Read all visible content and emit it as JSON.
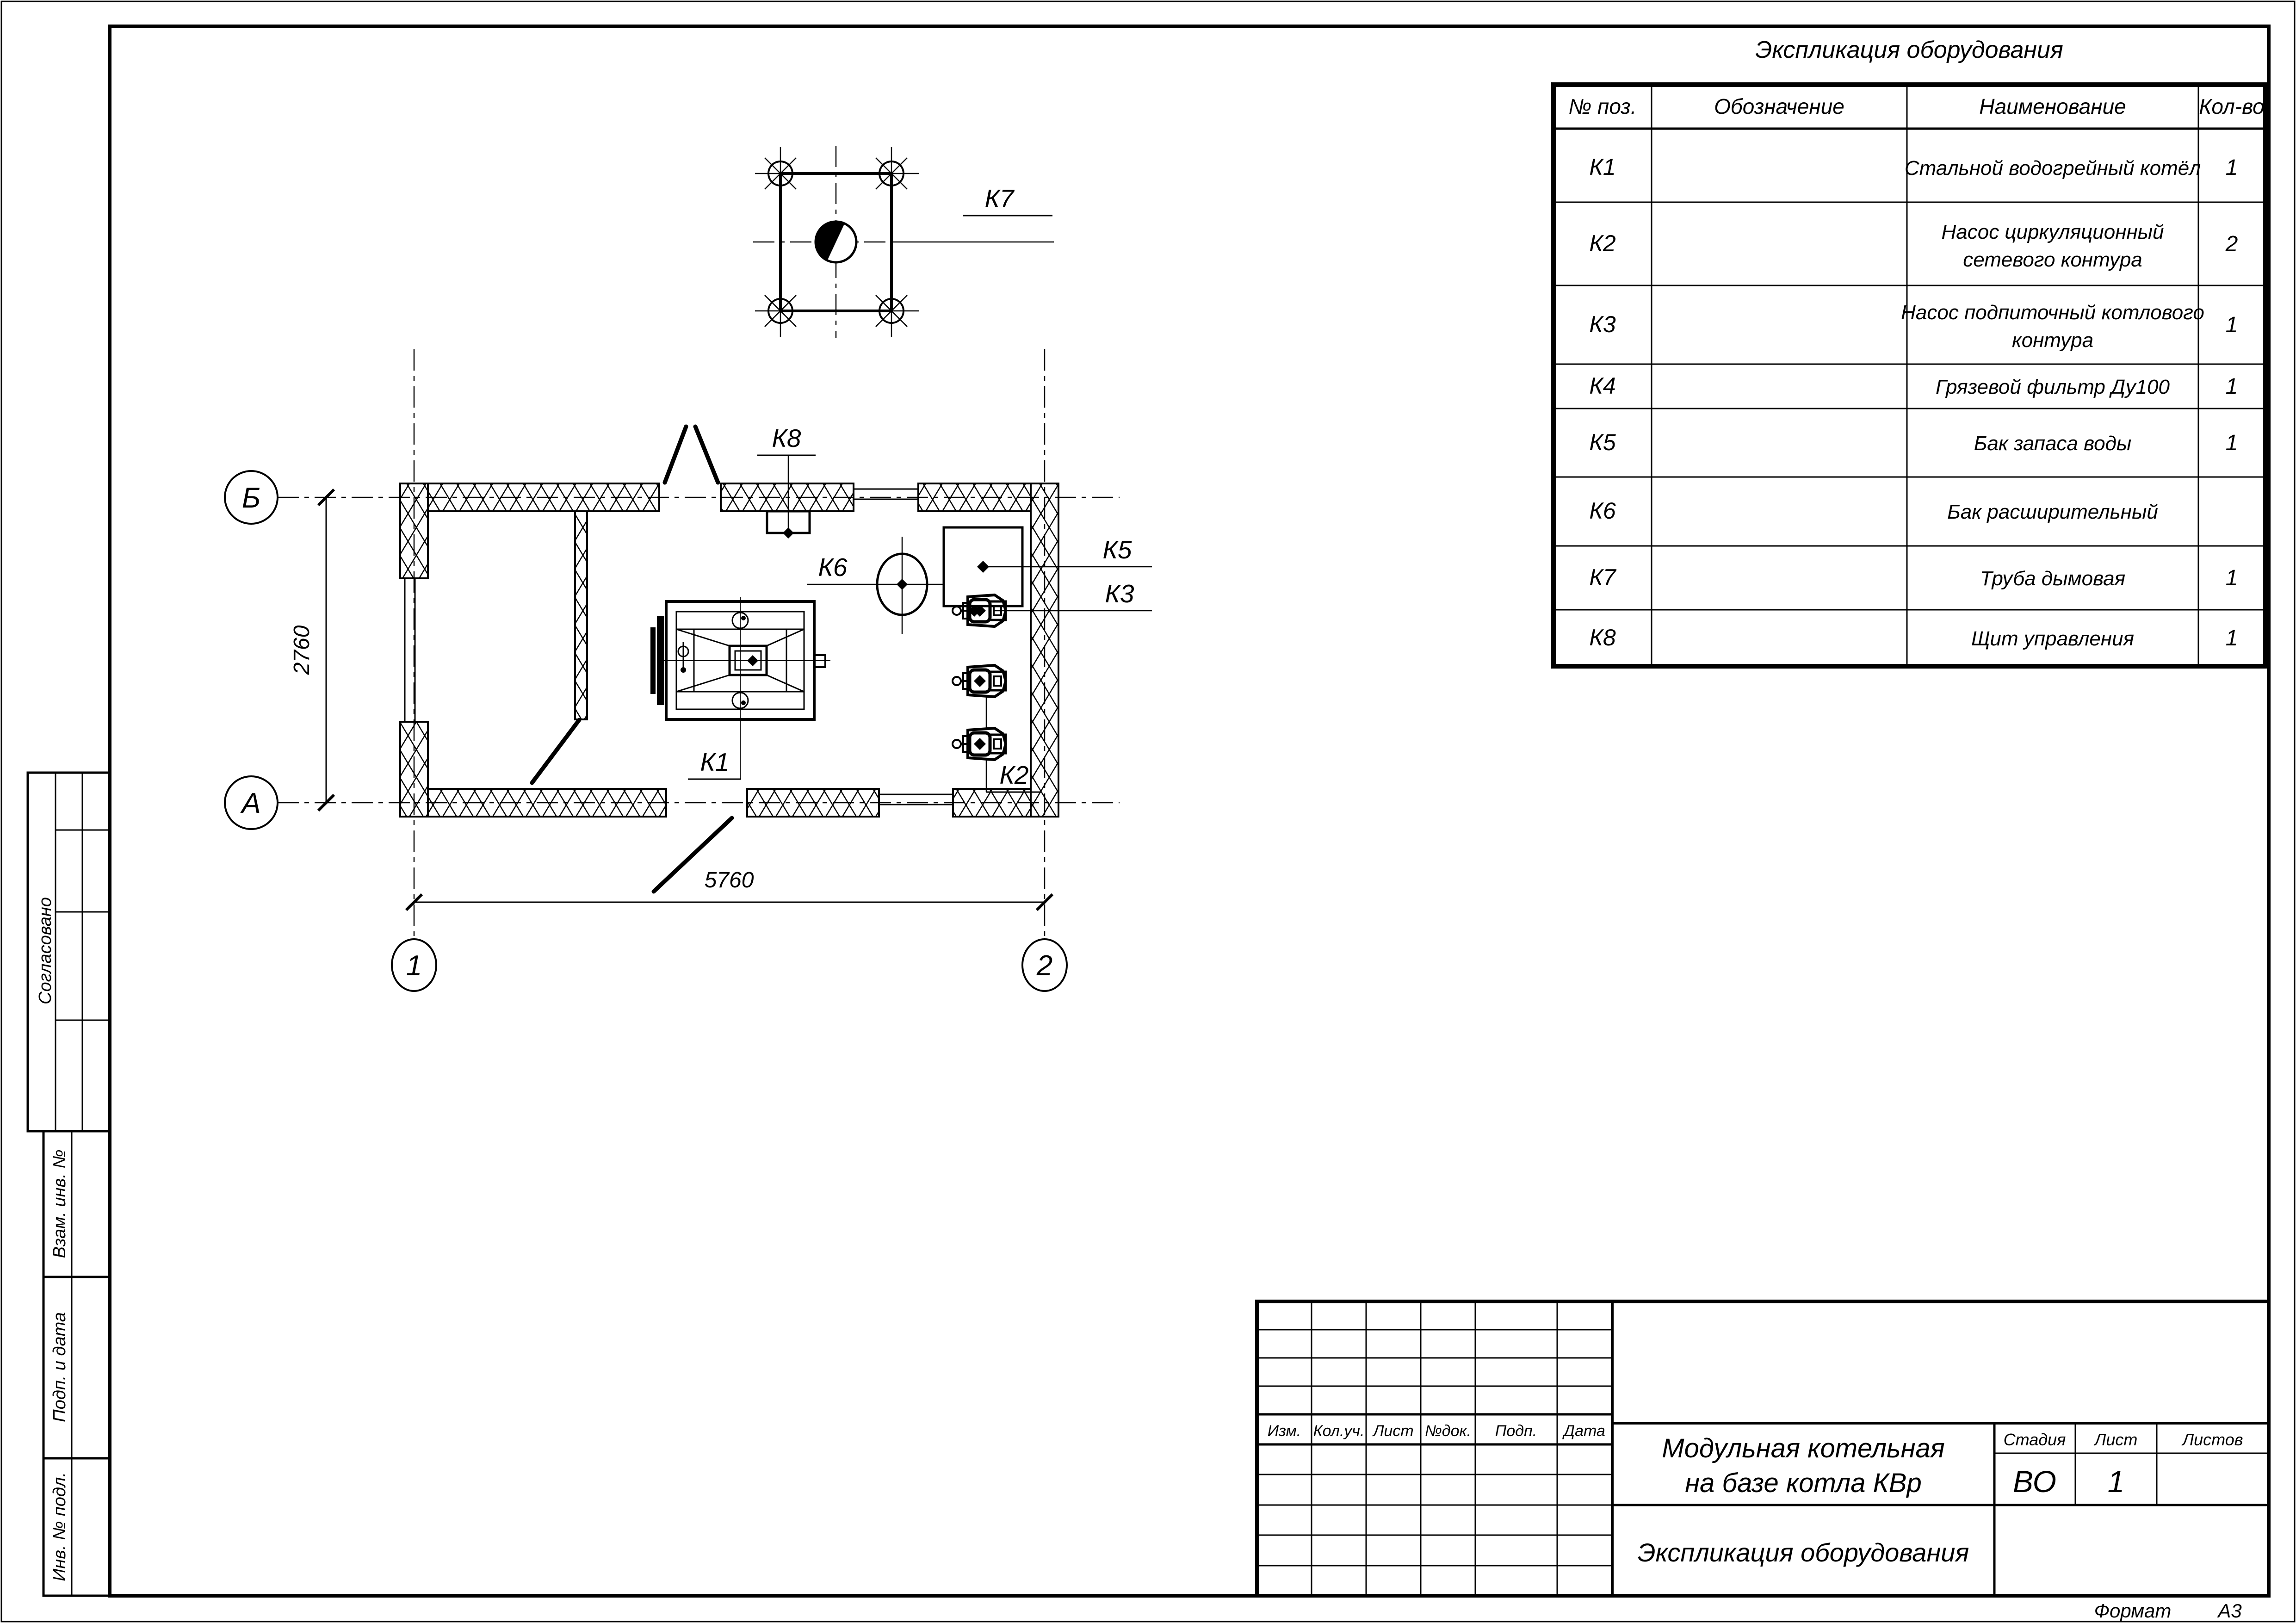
{
  "table": {
    "title": "Экспликация оборудования",
    "headers": [
      "№ поз.",
      "Обозначение",
      "Наименование",
      "Кол-во"
    ],
    "rows": [
      {
        "pos": "К1",
        "lines": [
          "Стальной водогрейный котёл"
        ],
        "qty": "1"
      },
      {
        "pos": "К2",
        "lines": [
          "Насос циркуляционный",
          "сетевого контура"
        ],
        "qty": "2"
      },
      {
        "pos": "К3",
        "lines": [
          "Насос подпиточный котлового",
          "контура"
        ],
        "qty": "1"
      },
      {
        "pos": "К4",
        "lines": [
          "Грязевой фильтр Ду100"
        ],
        "qty": "1"
      },
      {
        "pos": "К5",
        "lines": [
          "Бак запаса воды"
        ],
        "qty": "1"
      },
      {
        "pos": "К6",
        "lines": [
          "Бак расширительный"
        ],
        "qty": ""
      },
      {
        "pos": "К7",
        "lines": [
          "Труба дымовая"
        ],
        "qty": "1"
      },
      {
        "pos": "К8",
        "lines": [
          "Щит управления"
        ],
        "qty": "1"
      }
    ]
  },
  "plan": {
    "axis": {
      "b": "Б",
      "a": "А",
      "n1": "1",
      "n2": "2"
    },
    "dims": {
      "height": "2760",
      "width": "5760"
    },
    "tags": {
      "k1": "К1",
      "k2": "К2",
      "k3": "К3",
      "k5": "К5",
      "k6": "К6",
      "k7": "К7",
      "k8": "К8"
    }
  },
  "titleblock": {
    "change_headers": [
      "Изм.",
      "Кол.уч.",
      "Лист",
      "№док.",
      "Подп.",
      "Дата"
    ],
    "project_lines": [
      "Модульная котельная",
      "на базе котла КВр"
    ],
    "doc_title": "Экспликация оборудования",
    "stage_label": "Стадия",
    "sheet_label": "Лист",
    "sheets_label": "Листов",
    "stage_value": "ВО",
    "sheet_value": "1",
    "sheets_value": ""
  },
  "stamps": {
    "approved": "Согласовано",
    "replace_inv": "Взам. инв. №",
    "sign_date": "Подп. и дата",
    "inv_orig": "Инв. № подл."
  },
  "footer": {
    "format_label": "Формат",
    "format_value": "А3"
  }
}
